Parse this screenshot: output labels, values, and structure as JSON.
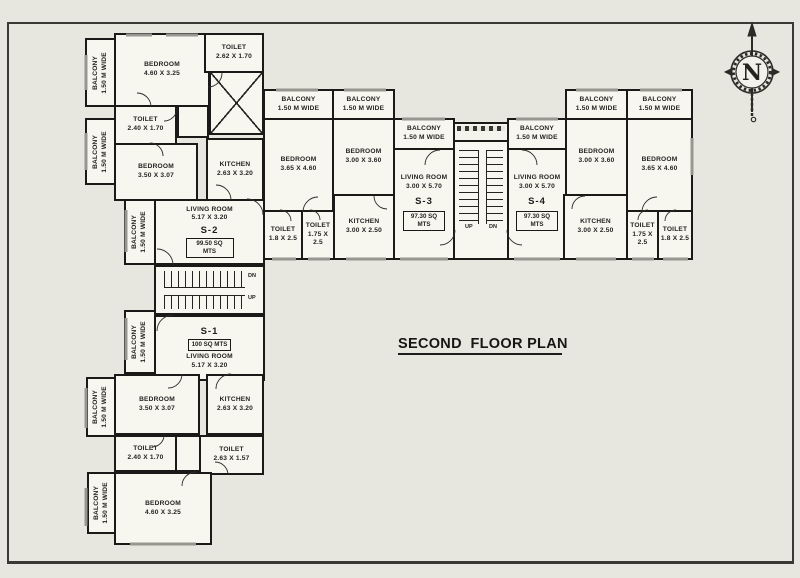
{
  "title": "SECOND  FLOOR PLAN",
  "compass_label": "N",
  "rooms": [
    {
      "id": "balcony-s2-a",
      "label": "BALCONY",
      "dims": "1.50 M WIDE",
      "x": 85,
      "y": 38,
      "w": 31,
      "h": 69,
      "vert": true
    },
    {
      "id": "bedroom-s2-a",
      "label": "BEDROOM",
      "dims": "4.60 X 3.25",
      "x": 114,
      "y": 33,
      "w": 96,
      "h": 74
    },
    {
      "id": "toilet-s2-a",
      "label": "TOILET",
      "dims": "2.62 X 1.70",
      "x": 204,
      "y": 33,
      "w": 60,
      "h": 40
    },
    {
      "id": "lift-shaft",
      "x": 209,
      "y": 71,
      "w": 55,
      "h": 64,
      "lift": true
    },
    {
      "id": "toilet-s2-b",
      "label": "TOILET",
      "dims": "2.40 X 1.70",
      "x": 114,
      "y": 105,
      "w": 63,
      "h": 40
    },
    {
      "id": "lobby-s2",
      "x": 177,
      "y": 105,
      "w": 32,
      "h": 33
    },
    {
      "id": "balcony-s2-b",
      "label": "BALCONY",
      "dims": "1.50 M WIDE",
      "x": 85,
      "y": 118,
      "w": 31,
      "h": 67,
      "vert": true
    },
    {
      "id": "bedroom-s2-b",
      "label": "BEDROOM",
      "dims": "3.50 X 3.07",
      "x": 114,
      "y": 143,
      "w": 84,
      "h": 58
    },
    {
      "id": "kitchen-s2",
      "label": "KITCHEN",
      "dims": "2.63 X 3.20",
      "x": 206,
      "y": 138,
      "w": 58,
      "h": 63
    },
    {
      "id": "balcony-s2-c",
      "label": "BALCONY",
      "dims": "1.50 M WIDE",
      "x": 124,
      "y": 199,
      "w": 32,
      "h": 66,
      "vert": true
    },
    {
      "id": "living-s2",
      "label": "LIVING ROOM",
      "dims": "5.17 X 3.20",
      "x": 154,
      "y": 199,
      "w": 111,
      "h": 66,
      "unit": "S-2",
      "area": "99.50 SQ MTS",
      "unit_pos": "below"
    },
    {
      "id": "stair-left",
      "stairs": "h",
      "x": 154,
      "y": 265,
      "w": 111,
      "h": 50,
      "s_labels": [
        {
          "g": "DN",
          "l": 92,
          "t": 6
        },
        {
          "g": "UP",
          "l": 92,
          "t": 28
        }
      ]
    },
    {
      "id": "living-s1",
      "label": "LIVING ROOM",
      "dims": "5.17 X 3.20",
      "x": 154,
      "y": 315,
      "w": 111,
      "h": 66,
      "unit": "S-1",
      "area": "100 SQ MTS",
      "unit_pos": "above"
    },
    {
      "id": "balcony-s1-a",
      "label": "BALCONY",
      "dims": "1.50 M WIDE",
      "x": 124,
      "y": 310,
      "w": 32,
      "h": 64,
      "vert": true
    },
    {
      "id": "bedroom-s1-a",
      "label": "BEDROOM",
      "dims": "3.50 X 3.07",
      "x": 114,
      "y": 374,
      "w": 86,
      "h": 61
    },
    {
      "id": "kitchen-s1",
      "label": "KITCHEN",
      "dims": "2.63 X 3.20",
      "x": 206,
      "y": 374,
      "w": 58,
      "h": 61
    },
    {
      "id": "balcony-s1-b",
      "label": "BALCONY",
      "dims": "1.50 M WIDE",
      "x": 86,
      "y": 377,
      "w": 30,
      "h": 60,
      "vert": true
    },
    {
      "id": "toilet-s1-a",
      "label": "TOILET",
      "dims": "2.40 X 1.70",
      "x": 114,
      "y": 435,
      "w": 63,
      "h": 37
    },
    {
      "id": "lobby-s1",
      "x": 175,
      "y": 435,
      "w": 26,
      "h": 37
    },
    {
      "id": "toilet-s1-b",
      "label": "TOILET",
      "dims": "2.63 X 1.57",
      "x": 199,
      "y": 435,
      "w": 65,
      "h": 40
    },
    {
      "id": "bedroom-s1-b",
      "label": "BEDROOM",
      "dims": "4.60 X 3.25",
      "x": 114,
      "y": 472,
      "w": 98,
      "h": 73
    },
    {
      "id": "balcony-s1-c",
      "label": "BALCONY",
      "dims": "1.50 M WIDE",
      "x": 87,
      "y": 472,
      "w": 29,
      "h": 62,
      "vert": true
    },
    {
      "id": "balcony-s3-a",
      "label": "BALCONY",
      "dims": "1.50 M WIDE",
      "x": 263,
      "y": 89,
      "w": 71,
      "h": 31
    },
    {
      "id": "balcony-s3-b",
      "label": "BALCONY",
      "dims": "1.50 M WIDE",
      "x": 332,
      "y": 89,
      "w": 63,
      "h": 31
    },
    {
      "id": "bedroom-s3-a",
      "label": "BEDROOM",
      "dims": "3.65 X 4.60",
      "x": 263,
      "y": 118,
      "w": 71,
      "h": 94
    },
    {
      "id": "bedroom-s3-b",
      "label": "BEDROOM",
      "dims": "3.00 X 3.60",
      "x": 332,
      "y": 118,
      "w": 63,
      "h": 78
    },
    {
      "id": "balcony-s3-c",
      "label": "BALCONY",
      "dims": "1.50 M WIDE",
      "x": 393,
      "y": 118,
      "w": 62,
      "h": 32
    },
    {
      "id": "living-s3",
      "label": "LIVING ROOM",
      "dims": "3.00 X 5.70",
      "x": 393,
      "y": 148,
      "w": 62,
      "h": 112,
      "unit": "S-3",
      "area": "97.30 SQ MTS",
      "unit_pos": "below",
      "tall": true
    },
    {
      "id": "toilet-s3-a",
      "label": "TOILET",
      "dims": "1.8 X 2.5",
      "x": 263,
      "y": 210,
      "w": 40,
      "h": 50
    },
    {
      "id": "toilet-s3-b",
      "label": "TOILET",
      "dims": "1.75 X 2.5",
      "x": 301,
      "y": 210,
      "w": 34,
      "h": 50
    },
    {
      "id": "kitchen-s3",
      "label": "KITCHEN",
      "dims": "3.00 X 2.50",
      "x": 333,
      "y": 194,
      "w": 62,
      "h": 66
    },
    {
      "id": "stair-landing-balcony",
      "x": 453,
      "y": 122,
      "w": 56,
      "h": 20,
      "hatch": true
    },
    {
      "id": "stair-center",
      "stairs": "v",
      "x": 453,
      "y": 140,
      "w": 56,
      "h": 120,
      "s_labels": [
        {
          "g": "UP",
          "l": 10,
          "t": 82
        },
        {
          "g": "DN",
          "l": 34,
          "t": 82
        }
      ]
    },
    {
      "id": "balcony-s4-a",
      "label": "BALCONY",
      "dims": "1.50 M WIDE",
      "x": 507,
      "y": 118,
      "w": 60,
      "h": 32
    },
    {
      "id": "living-s4",
      "label": "LIVING ROOM",
      "dims": "3.00 X 5.70",
      "x": 507,
      "y": 148,
      "w": 60,
      "h": 112,
      "unit": "S-4",
      "area": "97.30 SQ MTS",
      "unit_pos": "below",
      "tall": true
    },
    {
      "id": "balcony-s4-b",
      "label": "BALCONY",
      "dims": "1.50 M WIDE",
      "x": 565,
      "y": 89,
      "w": 63,
      "h": 31
    },
    {
      "id": "balcony-s4-c",
      "label": "BALCONY",
      "dims": "1.50 M WIDE",
      "x": 626,
      "y": 89,
      "w": 67,
      "h": 31
    },
    {
      "id": "bedroom-s4-a",
      "label": "BEDROOM",
      "dims": "3.00 X 3.60",
      "x": 565,
      "y": 118,
      "w": 63,
      "h": 78
    },
    {
      "id": "bedroom-s4-b",
      "label": "BEDROOM",
      "dims": "3.65 X 4.60",
      "x": 626,
      "y": 118,
      "w": 67,
      "h": 94
    },
    {
      "id": "kitchen-s4",
      "label": "KITCHEN",
      "dims": "3.00 X 2.50",
      "x": 563,
      "y": 194,
      "w": 65,
      "h": 66
    },
    {
      "id": "toilet-s4-a",
      "label": "TOILET",
      "dims": "1.75 X 2.5",
      "x": 626,
      "y": 210,
      "w": 33,
      "h": 50
    },
    {
      "id": "toilet-s4-b",
      "label": "TOILET",
      "dims": "1.8 X 2.5",
      "x": 657,
      "y": 210,
      "w": 36,
      "h": 50
    }
  ]
}
